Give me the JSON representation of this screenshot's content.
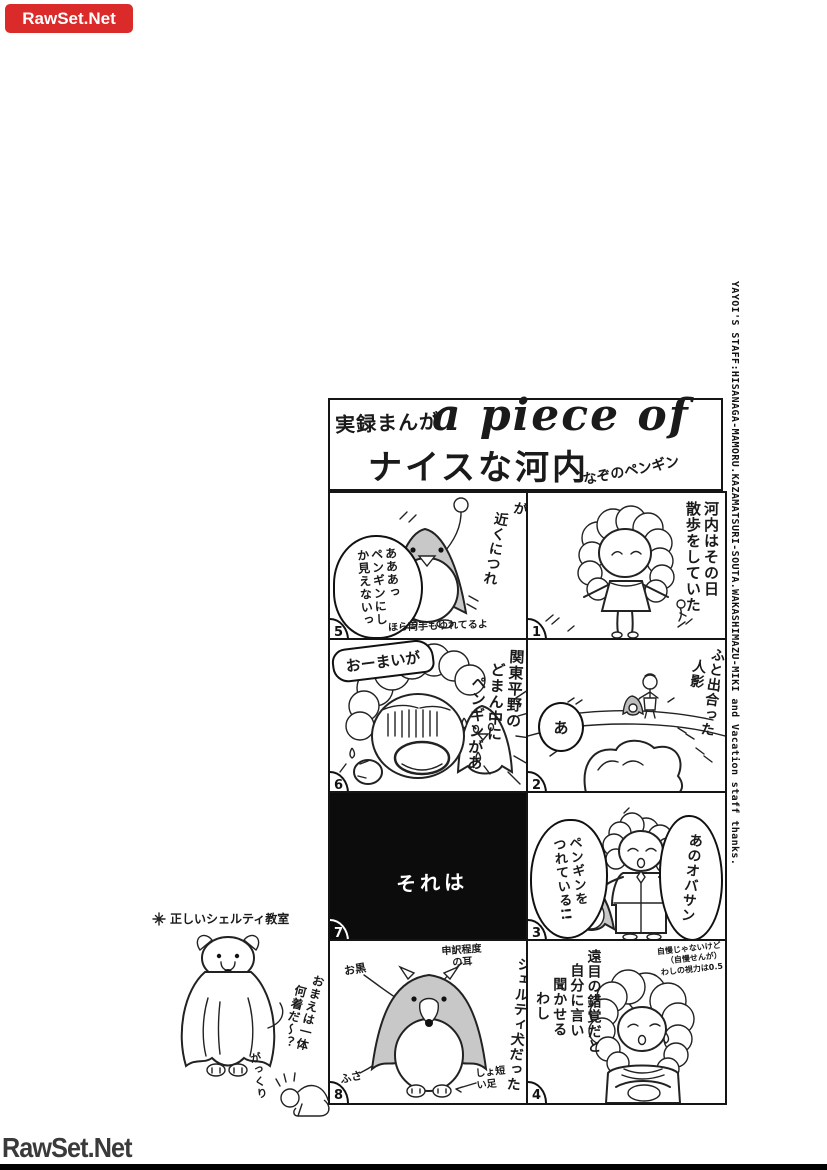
{
  "badge": {
    "label": "RawSet.Net"
  },
  "footer": {
    "label": "RawSet.Net"
  },
  "staff_credit": "YAYOI'S STAFF:HISANAGA-MAMORU.KAZAMATSURI-SOUTA.WAKASHIMAZU-MIKI and Vacation staff thanks.",
  "title": {
    "kicker": "実録まんが",
    "english": "a piece of",
    "main": "ナイスな河内",
    "subtitle": "なぞのペンギン"
  },
  "panels": {
    "p1": {
      "number": "1",
      "caption": [
        "河内はその日",
        "散歩をしていた"
      ]
    },
    "p2": {
      "number": "2",
      "caption": [
        "ふと出合った",
        "人影"
      ],
      "bubble": "あ"
    },
    "p3": {
      "number": "3",
      "bubble_left": [
        "ペンギンを",
        "つれている!!"
      ],
      "bubble_right": "あのオバサン"
    },
    "p4": {
      "number": "4",
      "caption": [
        "遠目の錯覚だと",
        "自分に言い",
        "聞かせる",
        "わし"
      ],
      "note": [
        "自慢じゃないけど",
        "（自慢せんが）",
        "わしの視力は0.5"
      ]
    },
    "p5": {
      "number": "5",
      "caption": [
        "が",
        "近くにつれ"
      ],
      "bubble": [
        "あああっ",
        "ペンギンにし",
        "か見えないっ"
      ],
      "note": "ほら両手もゆれてるよ"
    },
    "p6": {
      "number": "6",
      "exclaim": "おーまいが",
      "caption": [
        "関東平野の",
        "どまん中に",
        "ペンギンがあ"
      ]
    },
    "p7": {
      "number": "7",
      "caption": "それは"
    },
    "p8": {
      "number": "8",
      "caption": "シェルティ犬だった",
      "label_fur": "お黒",
      "label_ears": [
        "申訳程度",
        "の耳"
      ],
      "label_tuft": "ふさ",
      "label_legs": [
        "しょ短",
        "い足"
      ]
    }
  },
  "margin_art": {
    "heading": "正しいシェルティ教室",
    "comment": [
      "おまえは一体",
      "何着だ～？"
    ],
    "reaction": "がっくり"
  }
}
